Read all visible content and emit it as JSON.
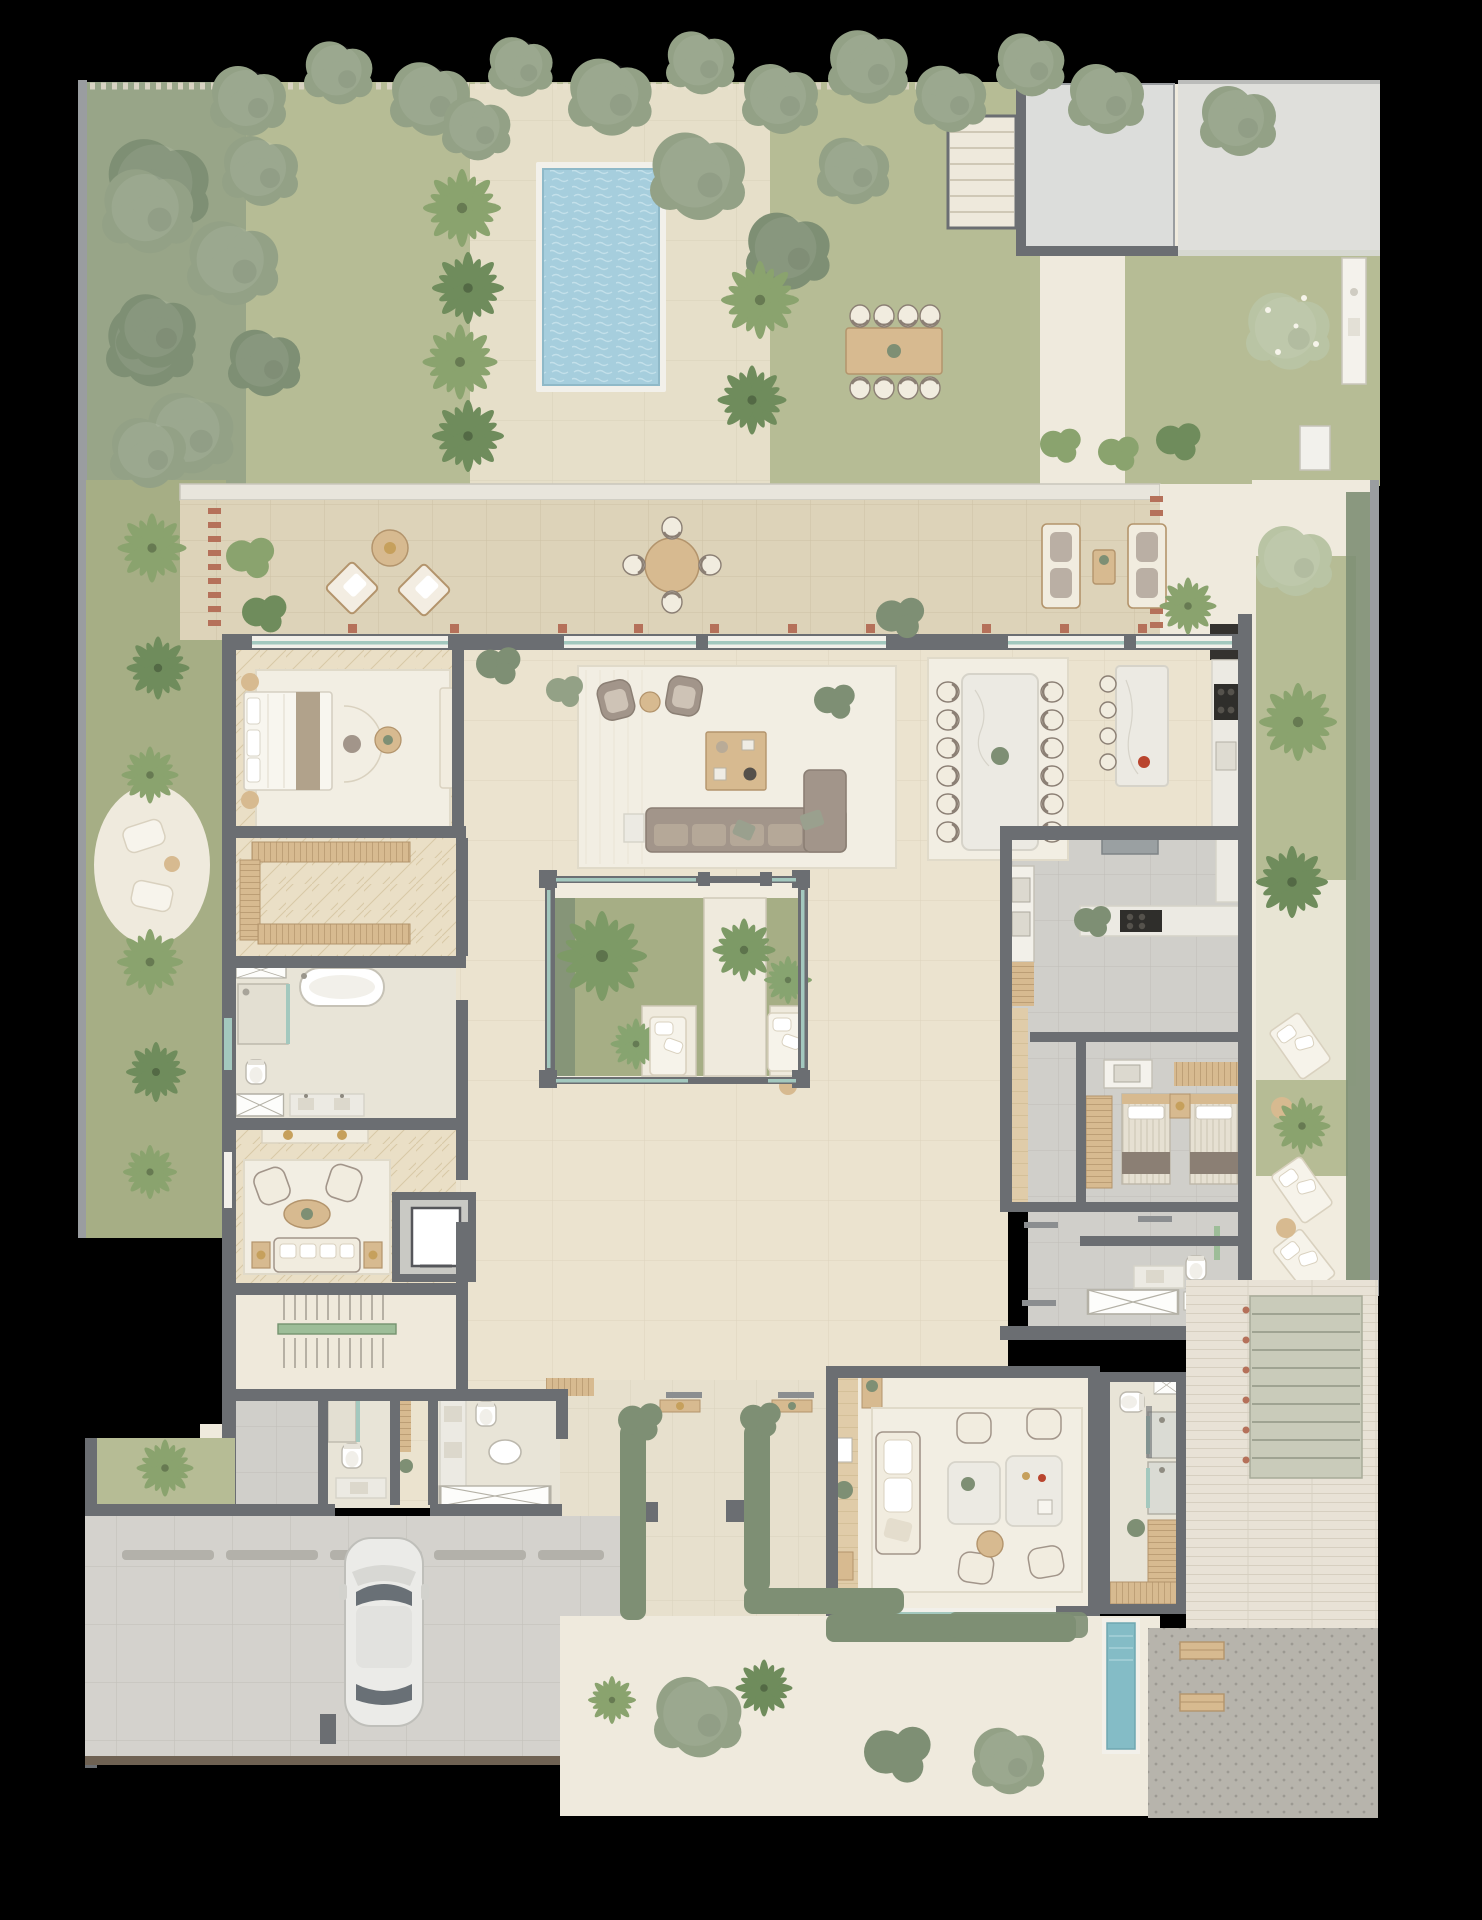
{
  "canvas": {
    "width": 1482,
    "height": 1920
  },
  "palette": {
    "bg": "#000000",
    "lawn": "#b6bc95",
    "lawnDark": "#a6ae85",
    "hedge": "#93a186",
    "hedgeDark": "#7e8f74",
    "palm": "#8aa36e",
    "palmDark": "#6f8c5c",
    "flower": "#b9c4a4",
    "stoneDeck": "#e9e3d2",
    "pathLight": "#efeadd",
    "terraceTile": "#ddd3b9",
    "terraceGrout": "#cdc2a5",
    "marbleFloor": "#ebe3cf",
    "marbleLine": "#dcd3bd",
    "herringbone": "#eadfc6",
    "herringLine": "#d8c9a6",
    "woodFloor": "#e0cca9",
    "wood": "#d7ba90",
    "woodDark": "#b3946c",
    "wall": "#6b6e72",
    "wallLight": "#9a9da0",
    "trim": "#f2f0ea",
    "glass": "#a3c8be",
    "brick": "#b5715a",
    "pool": "#a6cedd",
    "poolRipple": "#c3e0ea",
    "plunge": "#84bcc6",
    "cream": "#f1ecdf",
    "creamDark": "#d9d1bf",
    "taupe": "#a2958a",
    "taupeDark": "#8b7f74",
    "marble": "#eceae3",
    "marbleVein": "#d6d3c9",
    "grayTile": "#d0cfca",
    "grayLine": "#bfbeb8",
    "driveway": "#d4d2cd",
    "bump": "#b3b1aa",
    "concretePad": "#dcdddb",
    "terrazzo": "#b7b4ac",
    "terrazzoDot": "#9c9992",
    "brickPath": "#e8e2d6",
    "brickLine": "#d6cfc0",
    "gold": "#c6a05c",
    "appliance": "#34322f",
    "railGreen": "#9dbd98",
    "rug": "#f2eee3",
    "rugLine": "#e0dac9",
    "stone": "#e8e4d7"
  },
  "plan": {
    "type": "residential-villa-floor-plan",
    "view": "top-down",
    "areas": [
      "north-garden",
      "swimming-pool",
      "pool-deck",
      "outdoor-dining",
      "exterior-stair",
      "roof-pad",
      "north-terrace",
      "master-bedroom",
      "walk-in-closet",
      "master-bathroom",
      "sitting-room",
      "elevator",
      "main-stair",
      "entry-hall",
      "living-room",
      "central-courtyard",
      "dining-room",
      "kitchen",
      "service-kitchen",
      "pantry-corridor",
      "staff-bedroom",
      "staff-bathroom",
      "laundry",
      "west-garden",
      "east-garden",
      "garden-lounge",
      "spa-showers",
      "south-patio",
      "guest-bathrooms",
      "garage",
      "driveway",
      "plunge-pool",
      "southeast-stair",
      "brick-terrace",
      "south-garden"
    ],
    "furniture_counts": {
      "terrace_round_table_seats": 4,
      "outdoor_dining_seats": 8,
      "dining_table_chairs": 12,
      "kitchen_island_stools": 4,
      "courtyard_daybeds": 2,
      "east_garden_loungers": 3,
      "staff_single_beds": 2,
      "cars": 1
    }
  }
}
